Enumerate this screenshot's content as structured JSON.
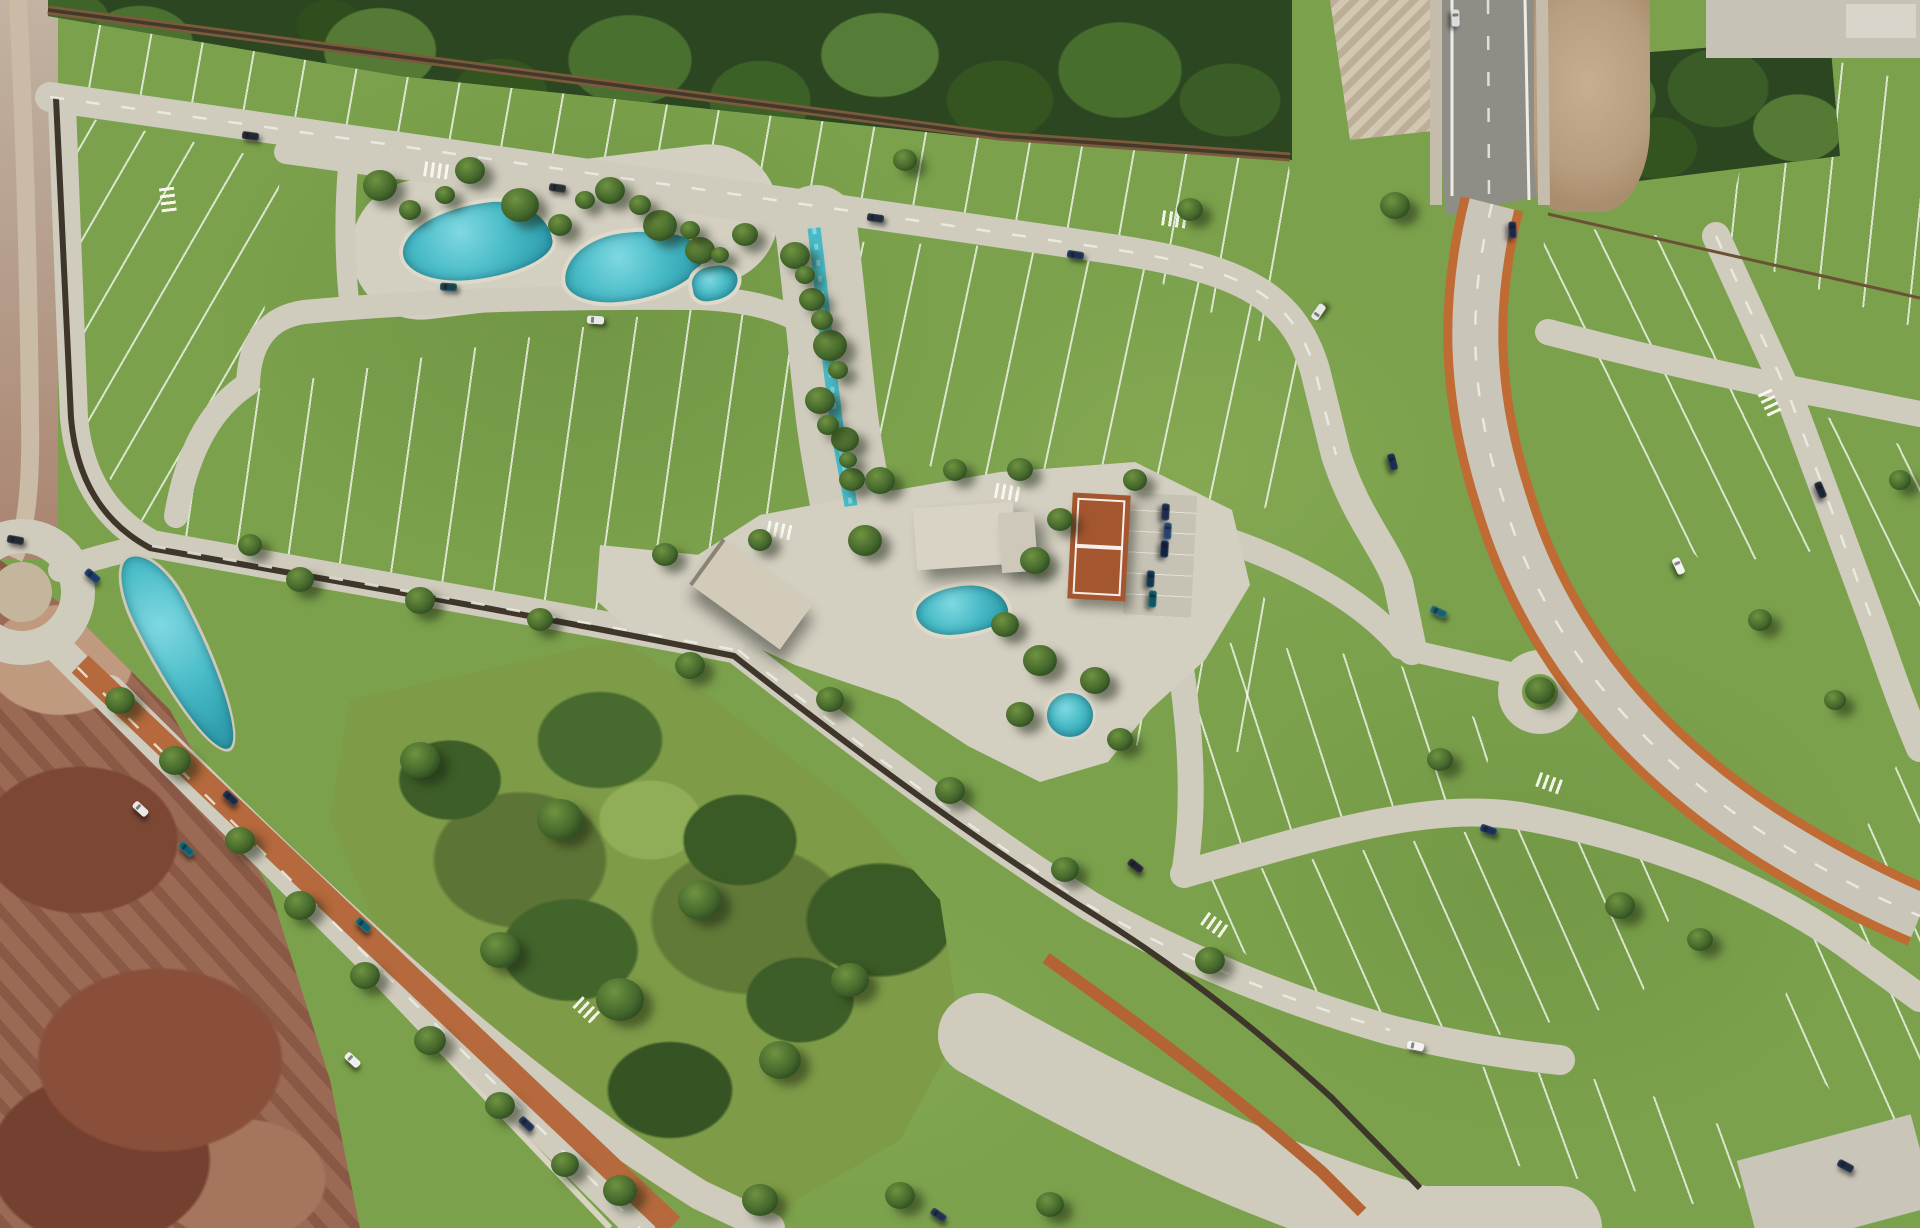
{
  "scene": {
    "title": "Aerial master-plan render of a residential lot development",
    "view": "top-down aerial 3D render",
    "setting": "gated community with amenity core, surrounded by forest belt, dirt terrain and arterial roads"
  },
  "palette": {
    "grass_base": "#7ba14c",
    "grass_light": "#8fb15a",
    "meadow": "#7e9b47",
    "forest_dark": "#2b4621",
    "forest_mid": "#44682c",
    "road": "#cfcbbd",
    "plaza": "#d3cfc1",
    "asphalt": "#8e8e87",
    "lot_line_white": "#f2f1ec",
    "wall_dark": "#3f362b",
    "path_brown": "#7a5b3c",
    "cycleway_orange": "#bf6b33",
    "water": "#2f9fae",
    "water_light": "#7fd8e0",
    "dirt_pink": "#9b6a54",
    "dirt_red": "#7c4735",
    "dirt_tan": "#b89e80",
    "roof_light": "#d8d3c5",
    "roof_beige": "#d2cbba",
    "tennis_clay": "#a4562f"
  },
  "features": [
    {
      "name": "forest-belt",
      "label": "Forest belt along north edge"
    },
    {
      "name": "northeast-forest-patch",
      "label": "Forest patch beside highway"
    },
    {
      "name": "residential-lot-blocks",
      "label": "Subdivided residential lots"
    },
    {
      "name": "lagoon-pool-west",
      "label": "West amenity lagoon pool"
    },
    {
      "name": "lagoon-pool-east",
      "label": "East amenity lagoon pool"
    },
    {
      "name": "creek",
      "label": "Landscaped creek"
    },
    {
      "name": "clubhouse-building",
      "label": "Clubhouse"
    },
    {
      "name": "clubhouse-pool",
      "label": "Clubhouse pool"
    },
    {
      "name": "tennis-court",
      "label": "Clay tennis court"
    },
    {
      "name": "parking-area",
      "label": "Clubhouse parking"
    },
    {
      "name": "ornamental-pond",
      "label": "Ornamental pond"
    },
    {
      "name": "entrance-portal-building",
      "label": "Entrance portal"
    },
    {
      "name": "roundabout",
      "label": "Entry roundabout"
    },
    {
      "name": "boulevard-median-lagoon",
      "label": "Boulevard median lagoon"
    },
    {
      "name": "median-jogging-path",
      "label": "Terracotta jogging path"
    },
    {
      "name": "avenue-cycleway",
      "label": "Avenue with orange cycle lanes"
    },
    {
      "name": "highway",
      "label": "Asphalt highway, top right"
    },
    {
      "name": "perimeter-wall",
      "label": "Dark perimeter wall"
    },
    {
      "name": "central-park",
      "label": "Central park meadow with tree clusters"
    },
    {
      "name": "dirt-terrain",
      "label": "Undeveloped reddish dirt terrain"
    },
    {
      "name": "cul-de-sac",
      "label": "Keyhole cul-de-sac"
    }
  ],
  "entities": {
    "trees": [
      [
        380,
        185,
        34
      ],
      [
        470,
        170,
        30
      ],
      [
        520,
        205,
        38
      ],
      [
        610,
        190,
        30
      ],
      [
        660,
        225,
        34
      ],
      [
        700,
        250,
        30
      ],
      [
        745,
        235,
        26
      ],
      [
        410,
        210,
        22
      ],
      [
        445,
        195,
        20
      ],
      [
        560,
        225,
        24
      ],
      [
        585,
        200,
        20
      ],
      [
        640,
        205,
        22
      ],
      [
        690,
        230,
        20
      ],
      [
        720,
        255,
        18
      ],
      [
        795,
        255,
        30
      ],
      [
        812,
        300,
        26
      ],
      [
        830,
        345,
        34
      ],
      [
        820,
        400,
        30
      ],
      [
        845,
        440,
        28
      ],
      [
        852,
        480,
        26
      ],
      [
        805,
        275,
        20
      ],
      [
        822,
        320,
        22
      ],
      [
        838,
        370,
        20
      ],
      [
        828,
        425,
        22
      ],
      [
        848,
        460,
        18
      ],
      [
        880,
        480,
        30
      ],
      [
        955,
        470,
        24
      ],
      [
        1020,
        470,
        26
      ],
      [
        865,
        540,
        34
      ],
      [
        1035,
        560,
        30
      ],
      [
        1005,
        625,
        28
      ],
      [
        1040,
        660,
        34
      ],
      [
        1095,
        680,
        30
      ],
      [
        1020,
        715,
        28
      ],
      [
        1120,
        740,
        26
      ],
      [
        1060,
        520,
        26
      ],
      [
        1135,
        480,
        24
      ],
      [
        665,
        555,
        26
      ],
      [
        760,
        540,
        24
      ],
      [
        690,
        665,
        30
      ],
      [
        250,
        545,
        24
      ],
      [
        300,
        580,
        28
      ],
      [
        420,
        600,
        30
      ],
      [
        540,
        620,
        26
      ],
      [
        120,
        700,
        30
      ],
      [
        175,
        760,
        32
      ],
      [
        240,
        840,
        30
      ],
      [
        300,
        905,
        32
      ],
      [
        365,
        975,
        30
      ],
      [
        430,
        1040,
        32
      ],
      [
        500,
        1105,
        30
      ],
      [
        565,
        1165,
        28
      ],
      [
        420,
        760,
        40
      ],
      [
        560,
        820,
        46
      ],
      [
        700,
        900,
        44
      ],
      [
        620,
        1000,
        48
      ],
      [
        780,
        1060,
        42
      ],
      [
        500,
        950,
        40
      ],
      [
        850,
        980,
        38
      ],
      [
        830,
        700,
        28
      ],
      [
        950,
        790,
        30
      ],
      [
        1065,
        870,
        28
      ],
      [
        1210,
        960,
        30
      ],
      [
        1395,
        205,
        30
      ],
      [
        1540,
        690,
        30
      ],
      [
        1440,
        760,
        26
      ],
      [
        1620,
        905,
        30
      ],
      [
        1700,
        940,
        26
      ],
      [
        1760,
        620,
        24
      ],
      [
        1835,
        700,
        22
      ],
      [
        1900,
        480,
        22
      ],
      [
        620,
        1190,
        34
      ],
      [
        760,
        1200,
        36
      ],
      [
        900,
        1195,
        30
      ],
      [
        1050,
        1205,
        28
      ],
      [
        905,
        160,
        24
      ],
      [
        1190,
        210,
        26
      ]
    ],
    "cars": [
      [
        250,
        136,
        8,
        "#23282e"
      ],
      [
        557,
        188,
        8,
        "#2a2d33"
      ],
      [
        595,
        320,
        4,
        "#e9e9e6"
      ],
      [
        448,
        287,
        4,
        "#14424d"
      ],
      [
        875,
        218,
        8,
        "#222c3e"
      ],
      [
        1075,
        255,
        9,
        "#1c2f4e"
      ],
      [
        1318,
        312,
        -55,
        "#e6e8e8"
      ],
      [
        1392,
        462,
        75,
        "#1b2c4f"
      ],
      [
        1438,
        612,
        25,
        "#17606c"
      ],
      [
        1488,
        830,
        20,
        "#1a2f55"
      ],
      [
        1678,
        566,
        65,
        "#f2f2f0"
      ],
      [
        1820,
        490,
        67,
        "#1d2433"
      ],
      [
        1415,
        1046,
        12,
        "#f4f4f2"
      ],
      [
        1135,
        866,
        38,
        "#20242c"
      ],
      [
        230,
        798,
        43,
        "#1b2a47"
      ],
      [
        186,
        849,
        43,
        "#0f606d"
      ],
      [
        140,
        809,
        43,
        "#e9e9e7"
      ],
      [
        526,
        1124,
        43,
        "#1c3050"
      ],
      [
        363,
        925,
        43,
        "#0f5f6e"
      ],
      [
        15,
        540,
        10,
        "#232a33"
      ],
      [
        92,
        576,
        40,
        "#1a3a63"
      ],
      [
        1165,
        512,
        93,
        "#1b2c50"
      ],
      [
        1167,
        531,
        93,
        "#25436e"
      ],
      [
        1164,
        549,
        93,
        "#0f2240"
      ],
      [
        1150,
        579,
        93,
        "#14344f"
      ],
      [
        1152,
        599,
        93,
        "#0c5562"
      ],
      [
        1512,
        230,
        88,
        "#1a2746"
      ],
      [
        1455,
        18,
        88,
        "#dcdcde"
      ],
      [
        1845,
        1166,
        28,
        "#1d2b45"
      ],
      [
        938,
        1215,
        35,
        "#22304a"
      ],
      [
        352,
        1060,
        43,
        "#eef0ee"
      ]
    ],
    "crosswalks": [
      [
        437,
        170,
        8
      ],
      [
        168,
        200,
        83
      ],
      [
        780,
        530,
        12
      ],
      [
        1175,
        219,
        8
      ],
      [
        1215,
        925,
        35
      ],
      [
        1550,
        783,
        20
      ],
      [
        1770,
        403,
        65
      ],
      [
        587,
        1010,
        43
      ],
      [
        1008,
        492,
        10
      ]
    ]
  }
}
